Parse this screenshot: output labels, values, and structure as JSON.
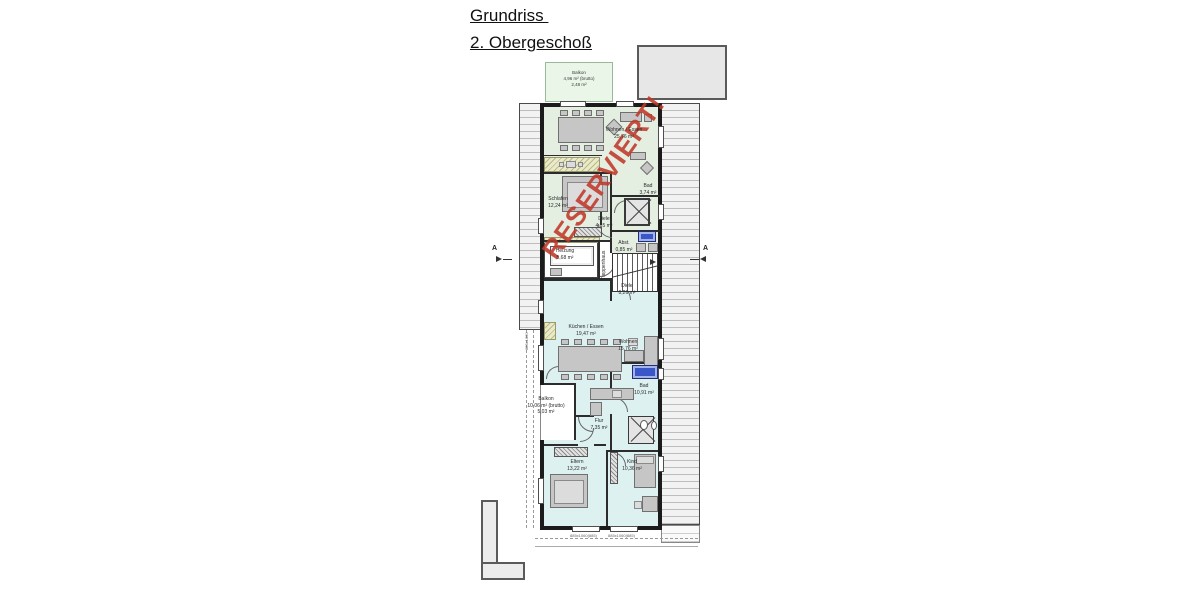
{
  "page": {
    "title_line1": "Grundriss ",
    "title_line2": "2. Obergeschoß"
  },
  "stamp": {
    "text": "RESERVIERT!",
    "color": "#c0392b"
  },
  "section_markers": {
    "left": "A",
    "right": "A"
  },
  "colors": {
    "upper_apartment_fill": "#e4efe1",
    "lower_apartment_fill": "#ddf1f0",
    "roof_fill": "#f2f2f2",
    "fixture_blue": "#3a57c9",
    "stamp_red": "#c0392b"
  },
  "rooms": {
    "balkon_top": {
      "name": "Balkon",
      "area": "4,96 m² (brutto)",
      "area2": "2,48 m²"
    },
    "wohnen_essen_og": {
      "name": "Wohnen / Essen",
      "area": "25,76 m²"
    },
    "schlafen": {
      "name": "Schlafen",
      "area": "12,24 m²"
    },
    "bad_og": {
      "name": "Bad",
      "area": "3,74 m²"
    },
    "diele_og": {
      "name": "Diele",
      "area": "4,85 m²"
    },
    "abstell": {
      "name": "Abst.",
      "area": "0,85 m²"
    },
    "heizung": {
      "name": "Heizung",
      "area": "5,68 m²"
    },
    "treppenhaus": {
      "name": "Treppenhaus"
    },
    "diele_lower": {
      "name": "Diele",
      "area": "8,26 m²"
    },
    "kueche": {
      "name": "Küchen / Essen",
      "area": "19,47 m²"
    },
    "wohnen_lower": {
      "name": "Wohnen",
      "area": "15,76 m²"
    },
    "bad_lower": {
      "name": "Bad",
      "area": "10,91 m²"
    },
    "balkon_lower": {
      "name": "Balkon",
      "area": "10,06 m² (brutto)",
      "area2": "5,03 m²"
    },
    "flur": {
      "name": "Flur",
      "area": "7,35 m²"
    },
    "eltern": {
      "name": "Eltern",
      "area": "13,22 m²"
    },
    "kind": {
      "name": "Kind",
      "area": "10,36 m²"
    }
  },
  "dimensions": {
    "window_bottom_left": "885x1060(885)",
    "window_bottom_right": "885x1060(885)",
    "window_side": "885x1060"
  }
}
